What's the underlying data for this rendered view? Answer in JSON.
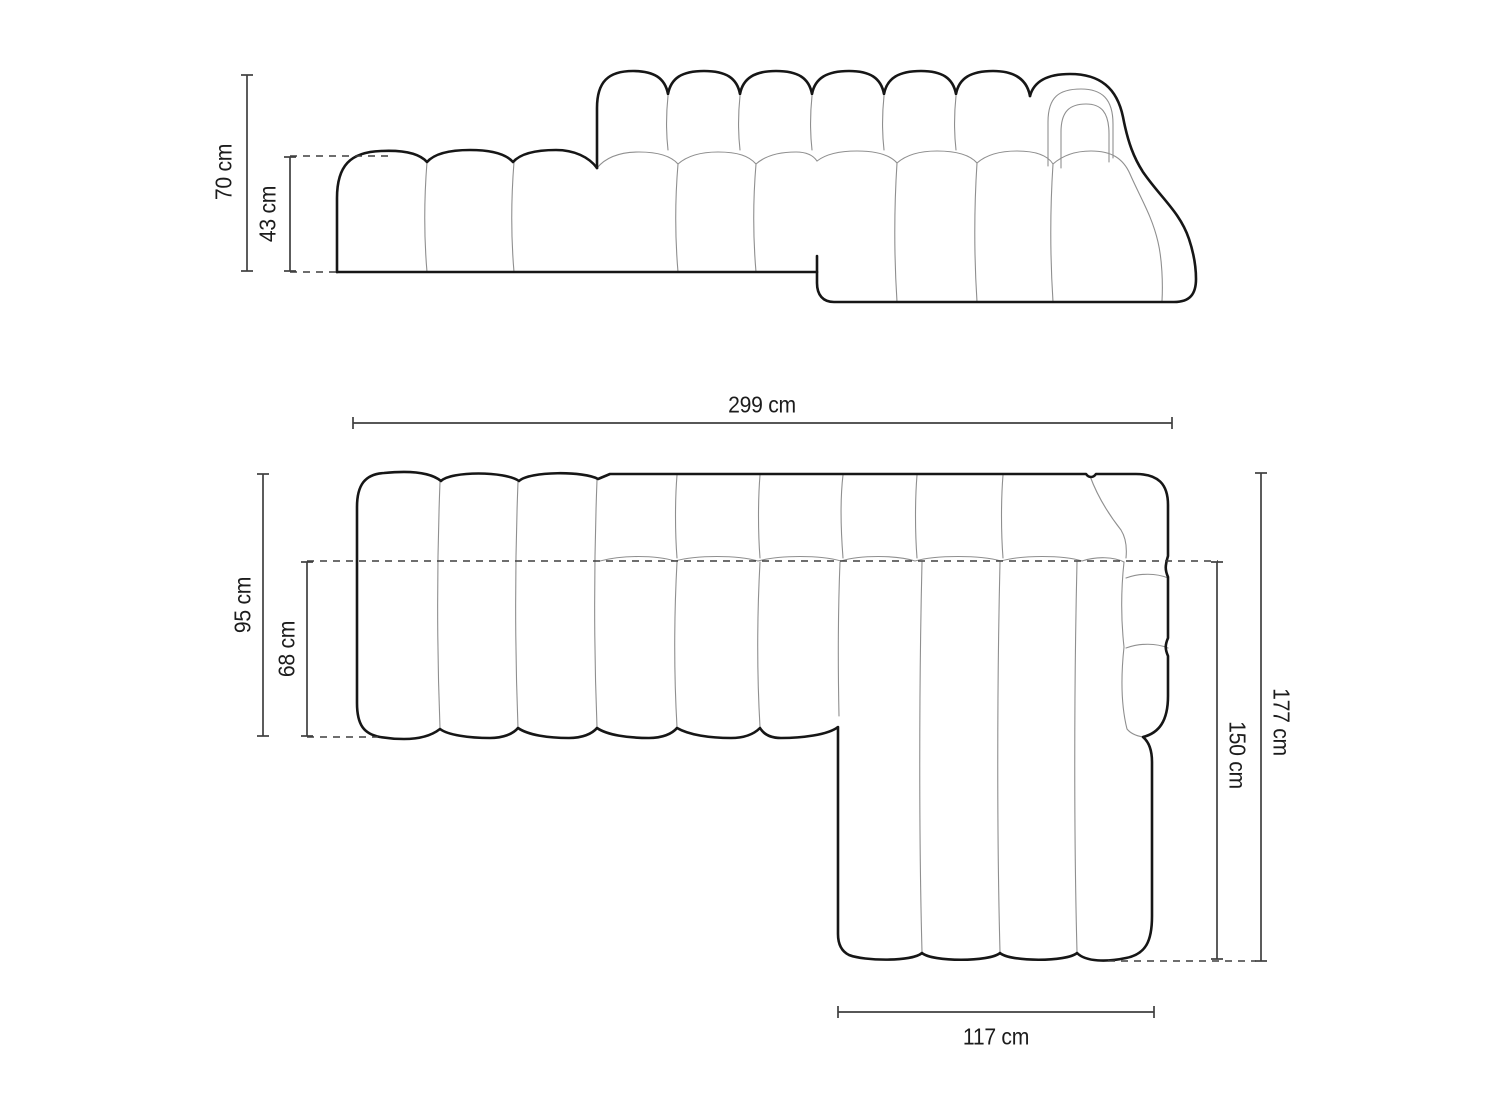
{
  "diagram": {
    "subject": "modular-corner-sofa-dimension-drawing",
    "views": {
      "front_view": "sofa-front-elevation",
      "top_view": "sofa-top-plan"
    },
    "colors": {
      "background": "#ffffff",
      "outline_heavy": "#161616",
      "outline_light": "#8f8f8f",
      "dimension_line": "#3f3f3f",
      "label_text": "#1c1c1c"
    },
    "labels": {
      "front_total_height": "70 cm",
      "front_seat_height": "43 cm",
      "top_total_width": "299 cm",
      "top_side_depth": "95 cm",
      "top_seat_depth": "68 cm",
      "top_total_depth": "177 cm",
      "top_chaise_length": "150 cm",
      "top_chaise_width": "117 cm"
    }
  }
}
